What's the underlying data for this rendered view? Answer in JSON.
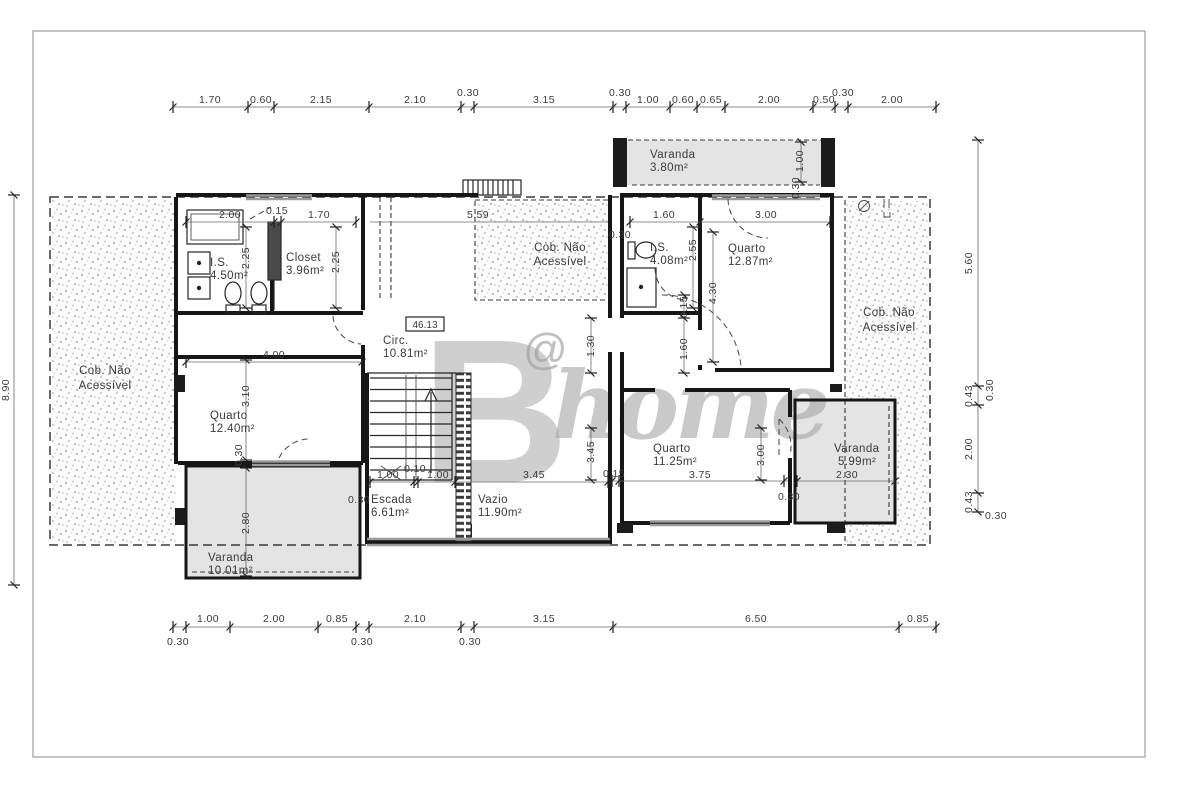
{
  "watermark": {
    "letter": "B",
    "at": "@",
    "word": "home"
  },
  "level_marker": "46.13",
  "rooms": {
    "is_left": {
      "name": "I.S.",
      "area": "4.50m²"
    },
    "closet": {
      "name": "Closet",
      "area": "3.96m²"
    },
    "circ": {
      "name": "Circ.",
      "area": "10.81m²"
    },
    "quarto_left": {
      "name": "Quarto",
      "area": "12.40m²"
    },
    "varanda_left": {
      "name": "Varanda",
      "area": "10.01m²"
    },
    "escada": {
      "name": "Escada",
      "area": "6.61m²"
    },
    "vazio": {
      "name": "Vazio",
      "area": "11.90m²"
    },
    "varanda_top": {
      "name": "Varanda",
      "area": "3.80m²"
    },
    "is_right": {
      "name": "I.S.",
      "area": "4.08m²"
    },
    "quarto_top_right": {
      "name": "Quarto",
      "area": "12.87m²"
    },
    "quarto_bottom_right": {
      "name": "Quarto",
      "area": "11.25m²"
    },
    "varanda_right": {
      "name": "Varanda",
      "area": "5.99m²"
    },
    "cob": {
      "line1": "Cob. Não",
      "line2": "Acessível"
    }
  },
  "dims": {
    "top": [
      "1.70",
      "0.60",
      "2.15",
      "2.10",
      "0.30",
      "3.15",
      "0.30",
      "1.00",
      "0.60",
      "0.65",
      "2.00",
      "0.50",
      "0.30",
      "2.00"
    ],
    "bottom": [
      "1.00",
      "2.00",
      "0.85",
      "2.10",
      "3.15",
      "6.50",
      "0.85"
    ],
    "bottom_offsets": [
      "0.30",
      "0.30",
      "0.30"
    ],
    "left": "8.90",
    "right": [
      "5.60",
      "0.43",
      "2.00",
      "0.43"
    ],
    "right_offsets": [
      "0.30",
      "0.30"
    ],
    "interior": {
      "w200": "2.00",
      "w015": "0.15",
      "w170": "1.70",
      "w225a": "2.25",
      "w225b": "2.25",
      "w559": "5.59",
      "w160h": "1.60",
      "w300h": "3.00",
      "w400": "4.00",
      "w310": "3.10",
      "w280": "2.80",
      "w030lv": "0.30",
      "w100a": "1.00",
      "w010": "0.10",
      "w100b": "1.00",
      "w030esc": "0.30",
      "w345h": "3.45",
      "w130": "1.30",
      "w345v": "3.45",
      "w015v": "0.15",
      "w160v": "1.60",
      "w255": "2.55",
      "w030is": "0.30",
      "w430": "4.30",
      "w100v": "1.00",
      "w030vt": "0.30",
      "w015q": "0.15",
      "w375": "3.75",
      "w300v": "3.00",
      "w030q": "0.30",
      "w230": "2.30"
    }
  }
}
